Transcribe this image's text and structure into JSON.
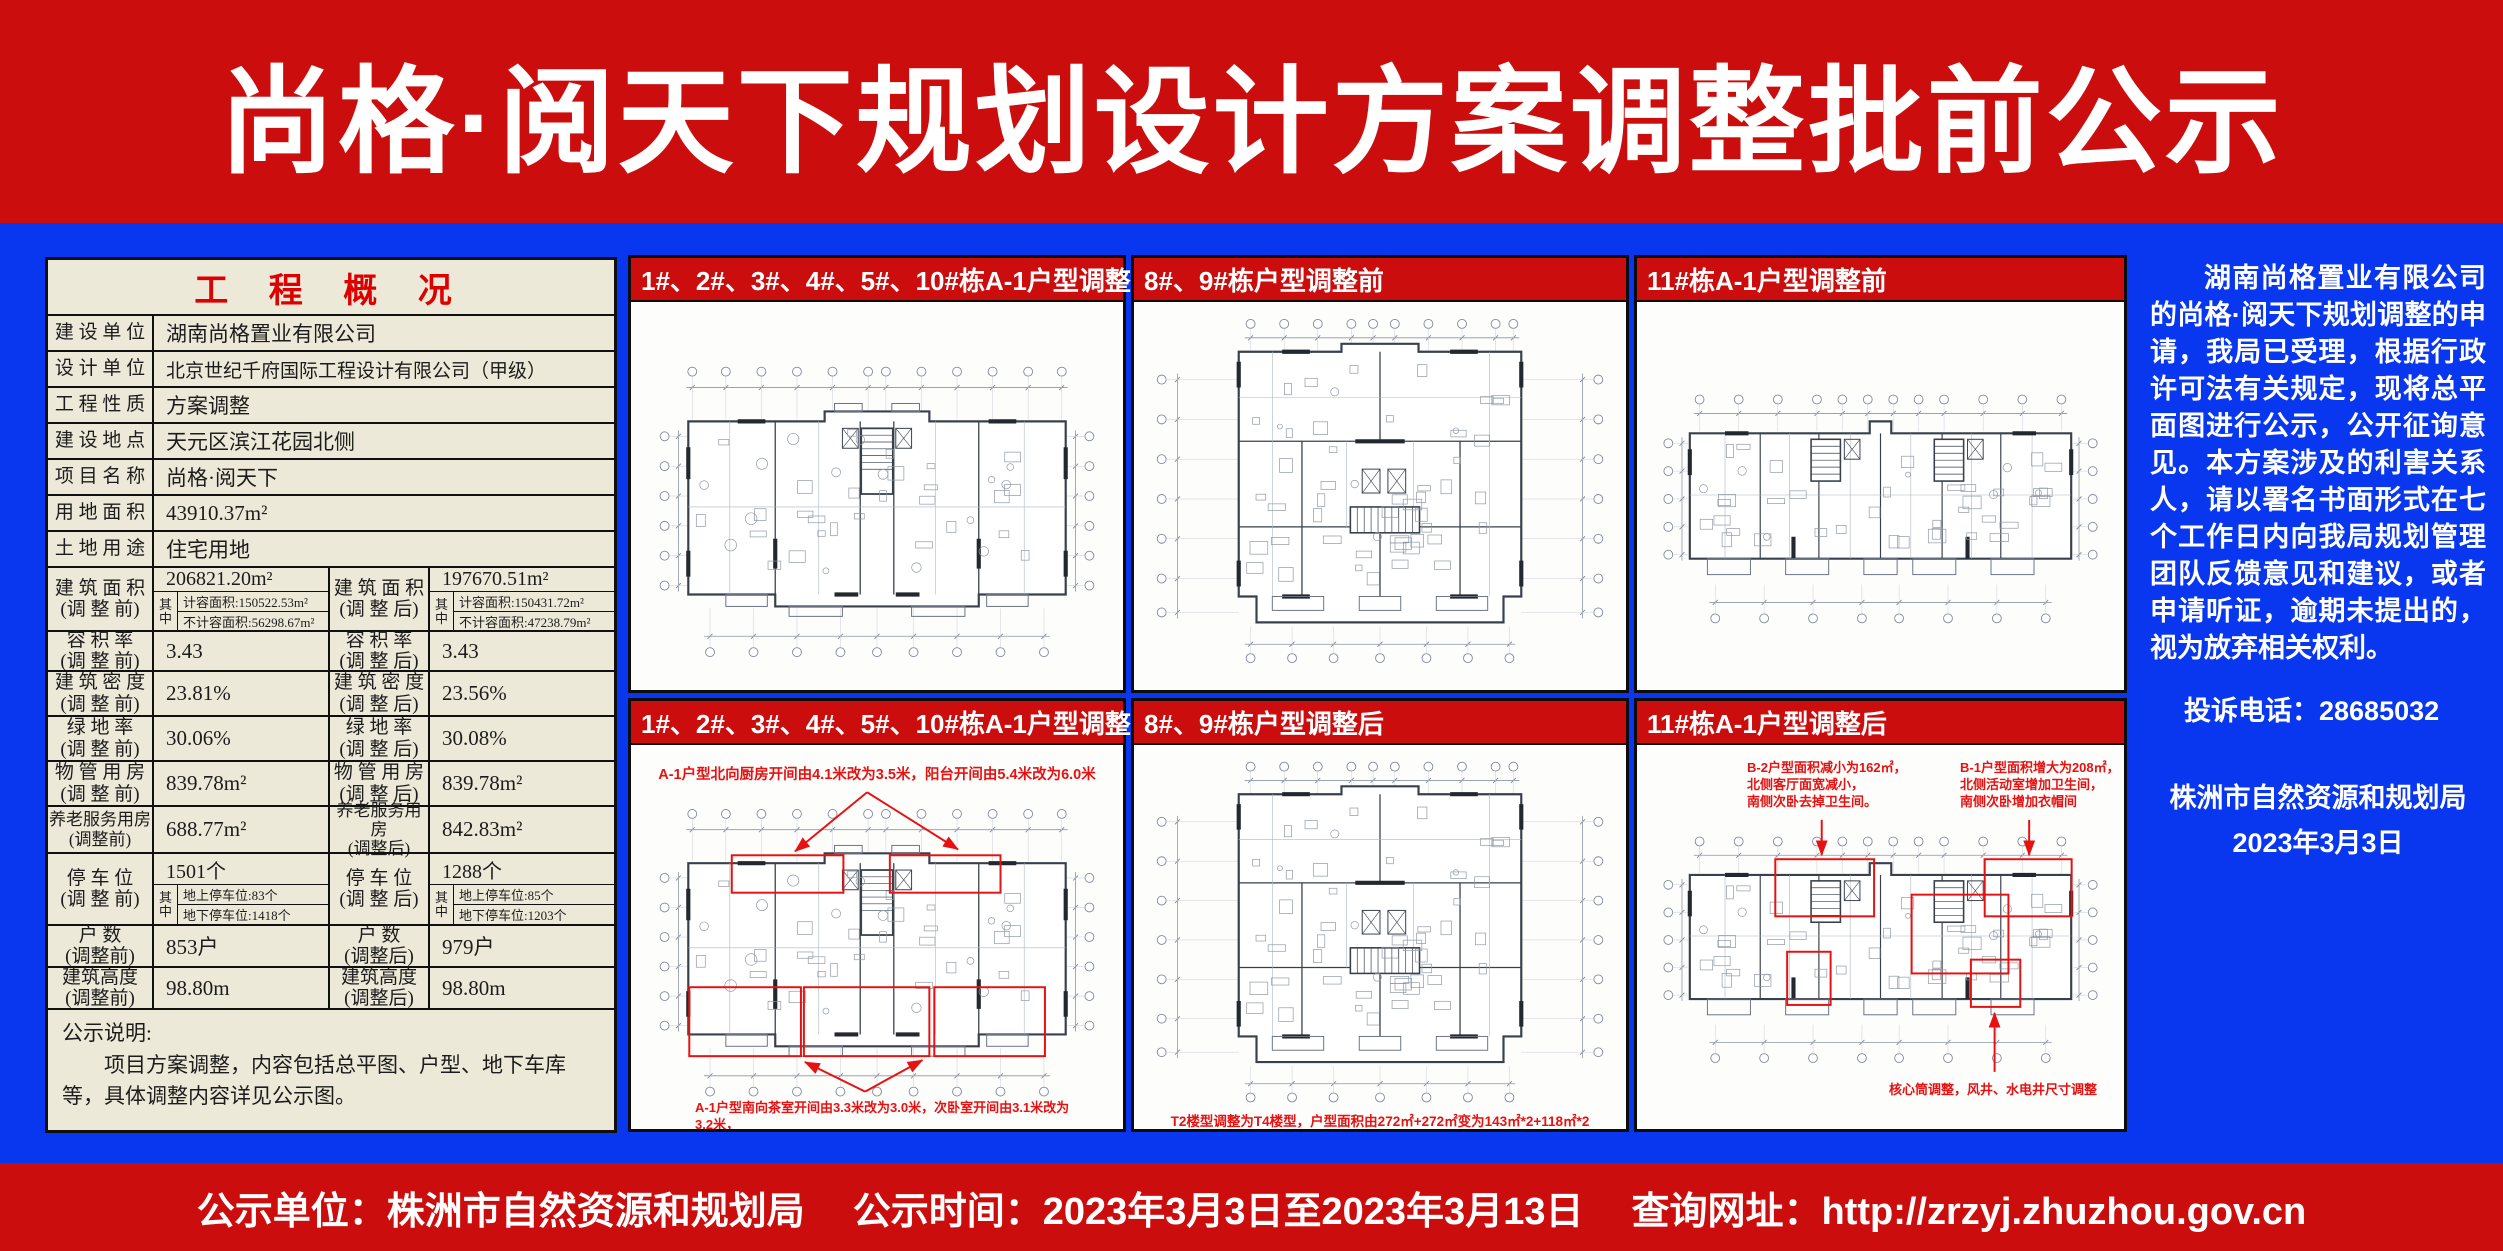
{
  "header": {
    "title": "尚格·阅天下规划设计方案调整批前公示"
  },
  "overview": {
    "title": "工 程 概 况",
    "rows": [
      {
        "label": "建 设 单 位",
        "value": "湖南尚格置业有限公司"
      },
      {
        "label": "设 计 单 位",
        "value": "北京世纪千府国际工程设计有限公司（甲级）"
      },
      {
        "label": "工 程 性 质",
        "value": "方案调整"
      },
      {
        "label": "建 设 地 点",
        "value": "天元区滨江花园北侧"
      },
      {
        "label": "项 目 名 称",
        "value": "尚格·阅天下"
      },
      {
        "label": "用 地 面 积",
        "value": "43910.37m²"
      },
      {
        "label": "土 地 用 途",
        "value": "住宅用地"
      }
    ],
    "area": {
      "label_before": "建 筑 面 积\n(调 整 前)",
      "before": "206821.20m²",
      "before_sub1": "计容面积:150522.53m²",
      "before_sub2": "不计容面积:56298.67m²",
      "label_after": "建 筑 面 积\n(调 整 后)",
      "after": "197670.51m²",
      "after_sub1": "计容面积:150431.72m²",
      "after_sub2": "不计容面积:47238.79m²",
      "qizhong": "其\n中"
    },
    "pairs": [
      {
        "lb": "容 积 率\n(调 整 前)",
        "vb": "3.43",
        "la": "容 积 率\n(调 整 后)",
        "va": "3.43"
      },
      {
        "lb": "建 筑 密 度\n(调 整 前)",
        "vb": "23.81%",
        "la": "建 筑 密 度\n(调 整 后)",
        "va": "23.56%"
      },
      {
        "lb": "绿 地 率\n(调 整 前)",
        "vb": "30.06%",
        "la": "绿 地 率\n(调 整 后)",
        "va": "30.08%"
      },
      {
        "lb": "物 管 用 房\n(调 整 前)",
        "vb": "839.78m²",
        "la": "物 管 用 房\n(调 整 后)",
        "va": "839.78m²"
      },
      {
        "lb": "养老服务用房\n(调整前)",
        "vb": "688.77m²",
        "la": "养老服务用房\n(调整后)",
        "va": "842.83m²"
      },
      {
        "lb": "户  数\n(调整前)",
        "vb": "853户",
        "la": "户  数\n(调整后)",
        "va": "979户"
      },
      {
        "lb": "建筑高度\n(调整前)",
        "vb": "98.80m",
        "la": "建筑高度\n(调整后)",
        "va": "98.80m"
      }
    ],
    "parking": {
      "label_before": "停 车 位\n(调 整 前)",
      "before": "1501个",
      "before_sub1": "地上停车位:83个",
      "before_sub2": "地下停车位:1418个",
      "label_after": "停 车 位\n(调 整 后)",
      "after": "1288个",
      "after_sub1": "地上停车位:85个",
      "after_sub2": "地下停车位:1203个",
      "qizhong": "其\n中"
    },
    "note_title": "公示说明:",
    "note_body": "项目方案调整，内容包括总平图、户型、地下车库等，具体调整内容详见公示图。"
  },
  "panels": [
    {
      "title": "1#、2#、3#、4#、5#、10#栋A-1户型调整前"
    },
    {
      "title": "8#、9#栋户型调整前"
    },
    {
      "title": "11#栋A-1户型调整前"
    },
    {
      "title": "1#、2#、3#、4#、5#、10#栋A-1户型调整后",
      "note_top": "A-1户型北向厨房开间由4.1米改为3.5米，阳台开间由5.4米改为6.0米",
      "note_bottom": "A-1户型南向茶室开间由3.3米改为3.0米，次卧室开间由3.1米改为3.2米，\n主卧室开间由3.7米改为3.9米。"
    },
    {
      "title": "8#、9#栋户型调整后",
      "note_bottom": "T2楼型调整为T4楼型，户型面积由272㎡+272㎡变为143㎡*2+118㎡*2"
    },
    {
      "title": "11#栋A-1户型调整后",
      "note_left": "B-2户型面积减小为162㎡，\n北侧客厅面宽减小，\n南侧次卧去掉卫生间。",
      "note_right": "B-1户型面积增大为208㎡，\n北侧活动室增加卫生间，\n南侧次卧增加衣帽间",
      "note_bottom": "核心筒调整，风井、水电井尺寸调整"
    }
  ],
  "notice": {
    "para": "湖南尚格置业有限公司的尚格·阅天下规划调整的申请，我局已受理，根据行政许可法有关规定，现将总平面图进行公示，公开征询意见。本方案涉及的利害关系人，请以署名书面形式在七个工作日内向我局规划管理团队反馈意见和建议，或者申请听证，逾期未提出的，视为放弃相关权利。",
    "phone": "投诉电话：28685032",
    "authority": "株洲市自然资源和规划局",
    "date": "2023年3月3日"
  },
  "footer": {
    "unit": "公示单位：株洲市自然资源和规划局",
    "time": "公示时间：2023年3月3日至2023年3月13日",
    "url": "查询网址：http://zrzyj.zhuzhou.gov.cn"
  }
}
